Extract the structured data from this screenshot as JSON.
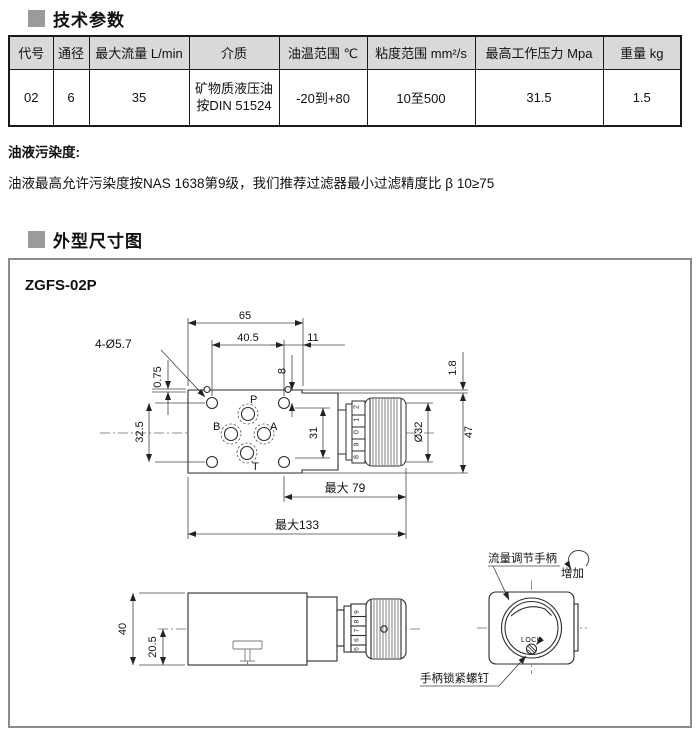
{
  "sections": {
    "params_title": "技术参数",
    "dims_title": "外型尺寸图"
  },
  "params_table": {
    "headers": [
      "代号",
      "通径",
      "最大流量 L/min",
      "介质",
      "油温范围 ℃",
      "粘度范围 mm²/s",
      "最高工作压力 Mpa",
      "重量 kg"
    ],
    "row": [
      "02",
      "6",
      "35",
      "矿物质液压油\n按DIN 51524",
      "-20到+80",
      "10至500",
      "31.5",
      "1.5"
    ]
  },
  "contamination": {
    "title": "油液污染度:",
    "text": "油液最高允许污染度按NAS 1638第9级，我们推荐过滤器最小过滤精度比 β 10≥75"
  },
  "drawing": {
    "model": "ZGFS-02P",
    "top_view": {
      "dim_width": "65",
      "dim_hole_spacing_h": "40.5",
      "dim_offset": "11",
      "label_holes": "4-Ø5.7",
      "dim_pin": "0.75",
      "dim_top_offset": "8",
      "dim_hole_spacing_v": "32.5",
      "dim_ports": "31",
      "dim_step": "1.8",
      "dim_knob_dia": "Ø32",
      "dim_height": "47",
      "dim_max_knob": "最大 79",
      "dim_max_total": "最大133",
      "port_p": "P",
      "port_b": "B",
      "port_a": "A",
      "port_t": "T",
      "dial_numbers": [
        "2",
        "1",
        "0",
        "9",
        "8"
      ]
    },
    "side_view": {
      "dim_height": "40",
      "dim_center_height": "20.5",
      "dial_numbers": [
        "9",
        "8",
        "7",
        "6",
        "5"
      ]
    },
    "front_view": {
      "label_handle": "流量调节手柄",
      "label_increase": "增加",
      "label_lock": "LOCK",
      "label_lock_screw": "手柄锁紧螺钉"
    }
  }
}
